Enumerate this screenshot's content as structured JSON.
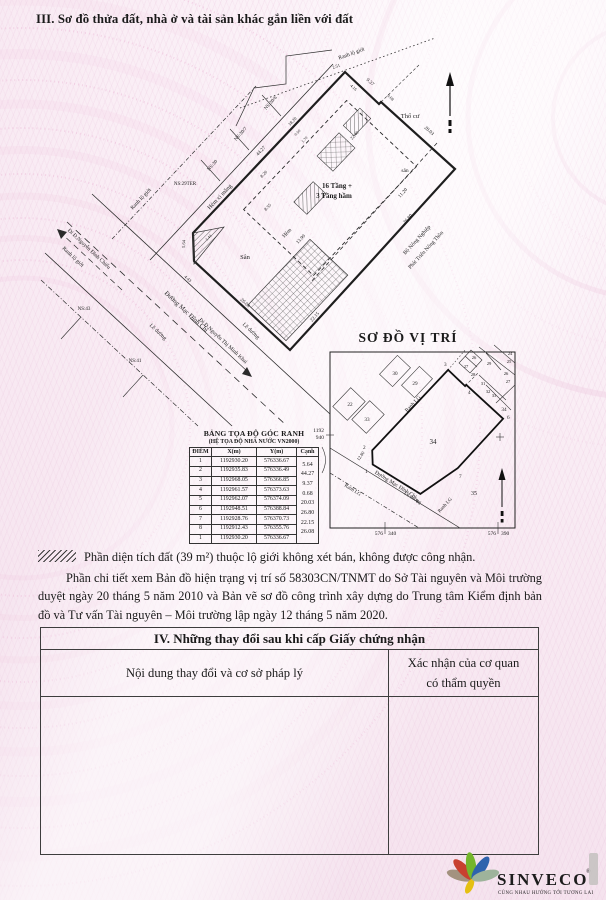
{
  "header": {
    "title": "III. Sơ đồ thửa đất, nhà ở và tài sản khác gắn liền với đất"
  },
  "plot": {
    "labels": {
      "ranh_lo_gioi_top": "Ranh lộ giới",
      "ranh_lo_gioi_mid": "Ranh lộ giới",
      "ranh_lo_gioi_sw": "Ranh lộ giới",
      "hem_xi_mang": "Hẻm xi măng",
      "ns_30_6": "NS:30/6",
      "ns_30_7": "NS:30/7",
      "ns_30": "NS:30",
      "ns_29ter": "NS:29TER",
      "ns_43": "NS:43",
      "ns_41": "NS:41",
      "duong_mac_dinh_chi": "Đường Mạc Đĩnh Chi",
      "di_nguyen_dinh_chieu": "Đi Đ.Nguyễn Đình Chiểu",
      "di_nguyen_thi_minh_khai": "Đi Đ.Nguyễn Thị Minh Khai",
      "le_duong_1": "Lề đường",
      "le_duong_2": "Lề đường",
      "san": "Sân",
      "san_small": "sân",
      "tho_cu": "Thổ cư",
      "hem": "Hẻm",
      "building_1": "16 Tầng +",
      "building_2": "3 Tầng hầm",
      "bo_nong_nghiep": "Bộ Nông Nghiệp",
      "phat_trien_nong_thon": "Phát Triển Nông Thôn"
    },
    "dims": {
      "e12": "5.64",
      "e23": "44.27",
      "e34": "9.37",
      "e45": "0.68",
      "e56": "20.03",
      "e67": "26.80",
      "e78": "22.15",
      "e81": "26.08",
      "seg_top": "2.51",
      "seg_top2": "4.16",
      "enc_a": "0.50",
      "enc_b": "1.70",
      "bld_a": "18.20",
      "bld_b": "22.40",
      "in_a": "8.20",
      "in_b": "8.55",
      "hem_len": "13.90",
      "hem_w": "11.20",
      "tri_a": "1.44",
      "tri_b": "4.43"
    }
  },
  "location_map": {
    "title": "SƠ ĐỒ VỊ TRÍ",
    "corner_labels": [
      "1",
      "2",
      "3",
      "4",
      "6",
      "7",
      "8"
    ],
    "parcel_numbers": [
      "30",
      "29",
      "26",
      "27",
      "28",
      "24",
      "25",
      "29",
      "26",
      "27",
      "31",
      "32",
      "33",
      "34",
      "22",
      "33",
      "34",
      "35"
    ],
    "labels": {
      "ranh_lg_nw": "Ranh LG",
      "ranh_lg_sw": "Ranh LG",
      "ranh_lg_se": "Ranh LG",
      "street": "Đường Mạc Đĩnh Chi",
      "le_duong": "Lề đường",
      "street_dim": "12.80"
    },
    "grid": {
      "x_a": "1192",
      "x_b": "940",
      "y1_a": "576",
      "y1_b": "340",
      "y2_a": "576",
      "y2_b": "390"
    }
  },
  "coord_table": {
    "title": "BẢNG TỌA ĐỘ GÓC RANH",
    "subtitle": "(HỆ TỌA ĐỘ NHÀ NƯỚC VN2000)",
    "headers": [
      "ĐIỂM",
      "X(m)",
      "Y(m)",
      "Cạnh"
    ],
    "rows": [
      {
        "p": "1",
        "x": "1192930.20",
        "y": "576336.67",
        "c": "5.64"
      },
      {
        "p": "2",
        "x": "1192935.83",
        "y": "576336.49",
        "c": "44.27"
      },
      {
        "p": "3",
        "x": "1192968.05",
        "y": "576366.85",
        "c": "9.37"
      },
      {
        "p": "4",
        "x": "1192961.57",
        "y": "576373.63",
        "c": "0.68"
      },
      {
        "p": "5",
        "x": "1192962.07",
        "y": "576374.09",
        "c": "20.03"
      },
      {
        "p": "6",
        "x": "1192948.51",
        "y": "576388.84",
        "c": "26.80"
      },
      {
        "p": "7",
        "x": "1192928.76",
        "y": "576370.73",
        "c": "22.15"
      },
      {
        "p": "8",
        "x": "1192912.43",
        "y": "576355.76",
        "c": "26.08"
      },
      {
        "p": "1",
        "x": "1192930.20",
        "y": "576336.67",
        "c": ""
      }
    ]
  },
  "notes": {
    "note1": "Phần diện tích đất (39 m²) thuộc lộ giới không xét bán, không được công nhận.",
    "note2": "Phần chi tiết xem Bản đồ hiện trạng vị trí số 58303CN/TNMT do Sở Tài nguyên và Môi trường duyệt ngày 20 tháng 5 năm 2010 và Bản vẽ sơ đồ công trình xây dựng do Trung tâm Kiểm định bản đồ và Tư vấn Tài nguyên – Môi trường lập ngày 12 tháng 5 năm 2020."
  },
  "section4": {
    "title": "IV. Những thay đổi sau khi cấp Giấy chứng nhận",
    "col1": "Nội dung thay đổi và cơ sở pháp lý",
    "col2a": "Xác nhận của cơ quan",
    "col2b": "có thẩm quyền"
  },
  "logo": {
    "name": "SINVECO",
    "reg": "®",
    "tagline": "CÙNG NHAU HƯỚNG TỚI TƯƠNG LAI",
    "petal_colors": [
      "#a3927f",
      "#c8402f",
      "#74b62c",
      "#2f63ad",
      "#e5c013",
      "#9eb39b"
    ],
    "text_color": "#9aa7b2",
    "tagline_color": "#f2a33c"
  }
}
